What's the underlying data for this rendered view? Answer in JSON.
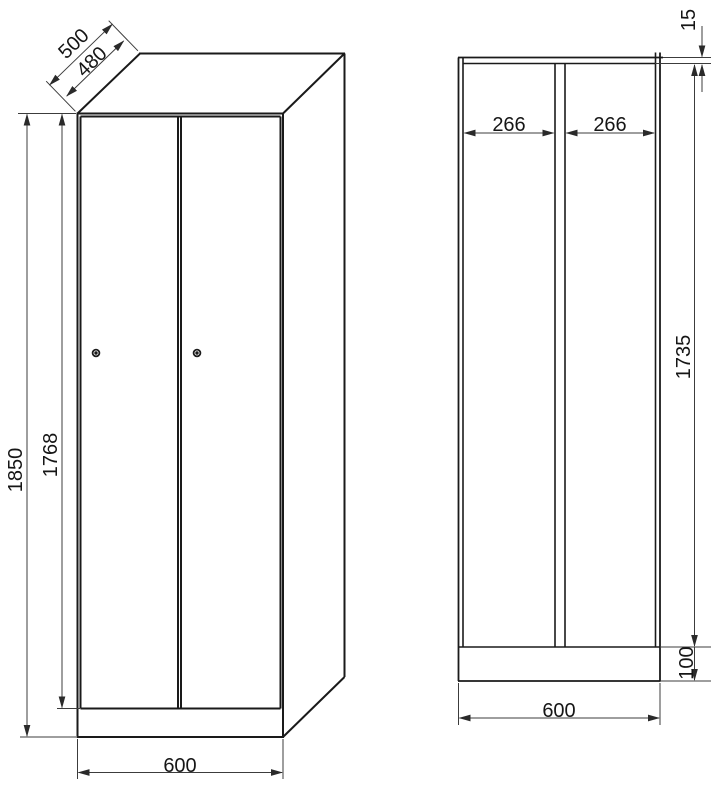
{
  "drawing": {
    "type": "technical-dimension-drawing",
    "subject": "two-door-locker-cabinet",
    "front_view": {
      "labels": {
        "height_total": "1850",
        "door_height": "1768",
        "width": "600",
        "depth_outer": "500",
        "depth_inner": "480"
      }
    },
    "section_view": {
      "labels": {
        "compartment_left": "266",
        "compartment_right": "266",
        "top_panel_thickness": "15",
        "interior_height": "1735",
        "plinth_height": "100",
        "width": "600"
      }
    },
    "colors": {
      "background": "#ffffff",
      "outline": "#1a1a1a",
      "dimension_line": "#3c3c3c",
      "text": "#161616"
    }
  }
}
